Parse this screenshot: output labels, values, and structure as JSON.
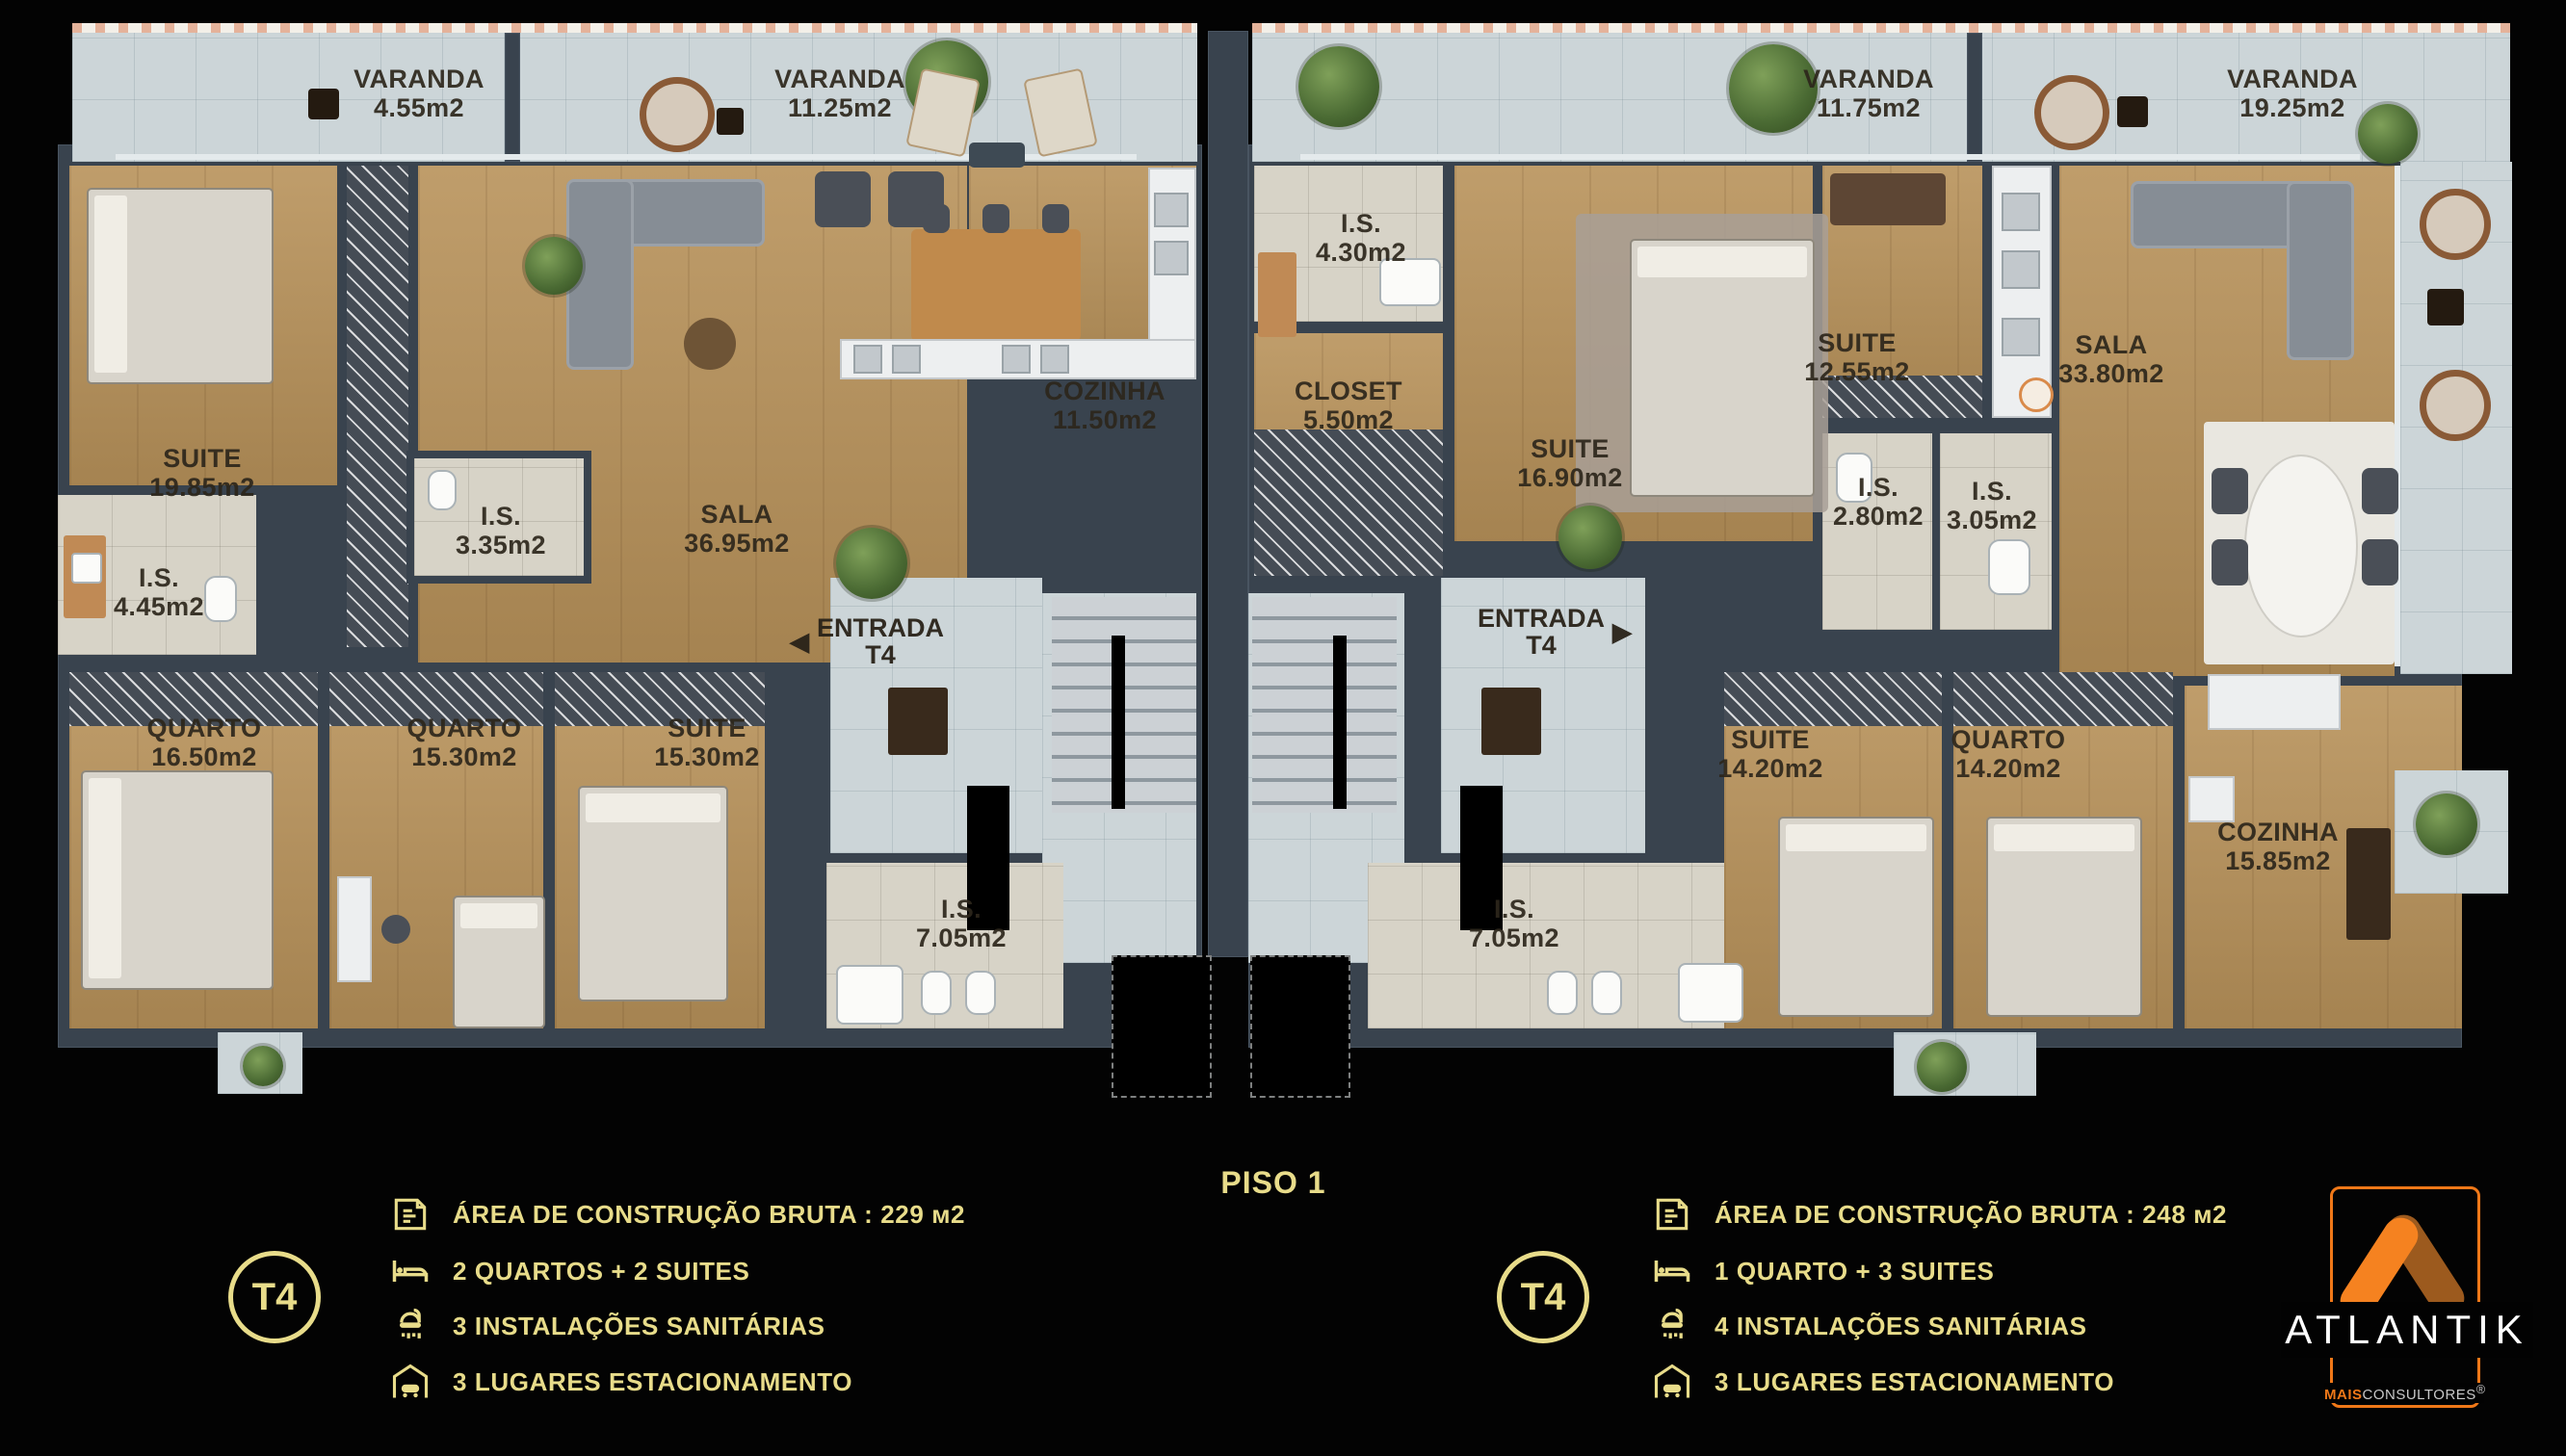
{
  "title": {
    "floor": "PISO 1"
  },
  "plan": {
    "left": {
      "varandas": [
        {
          "name": "VARANDA",
          "area": "4.55m2"
        },
        {
          "name": "VARANDA",
          "area": "11.25m2"
        }
      ],
      "rooms": {
        "suite1": {
          "name": "SUITE",
          "area": "19.85m2"
        },
        "is1": {
          "name": "I.S.",
          "area": "4.45m2"
        },
        "is2": {
          "name": "I.S.",
          "area": "3.35m2"
        },
        "sala": {
          "name": "SALA",
          "area": "36.95m2"
        },
        "cozinha": {
          "name": "COZINHA",
          "area": "11.50m2"
        },
        "entrada": {
          "name": "ENTRADA",
          "unit": "T4",
          "arrow": "◀"
        },
        "quarto1": {
          "name": "QUARTO",
          "area": "16.50m2"
        },
        "quarto2": {
          "name": "QUARTO",
          "area": "15.30m2"
        },
        "suite2": {
          "name": "SUITE",
          "area": "15.30m2"
        },
        "is3": {
          "name": "I.S.",
          "area": "7.05m2"
        }
      }
    },
    "right": {
      "varandas": [
        {
          "name": "VARANDA",
          "area": "11.75m2"
        },
        {
          "name": "VARANDA",
          "area": "19.25m2"
        }
      ],
      "rooms": {
        "is1": {
          "name": "I.S.",
          "area": "4.30m2"
        },
        "closet": {
          "name": "CLOSET",
          "area": "5.50m2"
        },
        "suite1": {
          "name": "SUITE",
          "area": "16.90m2"
        },
        "suite2": {
          "name": "SUITE",
          "area": "12.55m2"
        },
        "is2": {
          "name": "I.S.",
          "area": "2.80m2"
        },
        "is3": {
          "name": "I.S.",
          "area": "3.05m2"
        },
        "sala": {
          "name": "SALA",
          "area": "33.80m2"
        },
        "entrada": {
          "name": "ENTRADA",
          "unit": "T4",
          "arrow": "▶"
        },
        "suite3": {
          "name": "SUITE",
          "area": "14.20m2"
        },
        "quarto1": {
          "name": "QUARTO",
          "area": "14.20m2"
        },
        "cozinha": {
          "name": "COZINHA",
          "area": "15.85m2"
        },
        "is4": {
          "name": "I.S.",
          "area": "7.05m2"
        }
      }
    }
  },
  "legend_left": {
    "badge": "T4",
    "rows": [
      {
        "label": "ÁREA DE CONSTRUÇÃO BRUTA :  229 м2"
      },
      {
        "label": "2 QUARTOS + 2 SUITES"
      },
      {
        "label": "3 INSTALAÇÕES SANITÁRIAS"
      },
      {
        "label": "3 LUGARES ESTACIONAMENTO"
      }
    ]
  },
  "legend_right": {
    "badge": "T4",
    "rows": [
      {
        "label": "ÁREA DE CONSTRUÇÃO BRUTA :  248 м2"
      },
      {
        "label": "1 QUARTO + 3 SUITES"
      },
      {
        "label": "4 INSTALAÇÕES SANITÁRIAS"
      },
      {
        "label": "3 LUGARES ESTACIONAMENTO"
      }
    ]
  },
  "brand": {
    "name": "ATLANTIK",
    "sub_bold": "MAIS",
    "sub_rest": "CONSULTORES",
    "reg": "®"
  },
  "colors": {
    "gold": "#e8dc8a",
    "orange": "#f07818",
    "wood": "#b8925a",
    "wall": "#39434e"
  }
}
